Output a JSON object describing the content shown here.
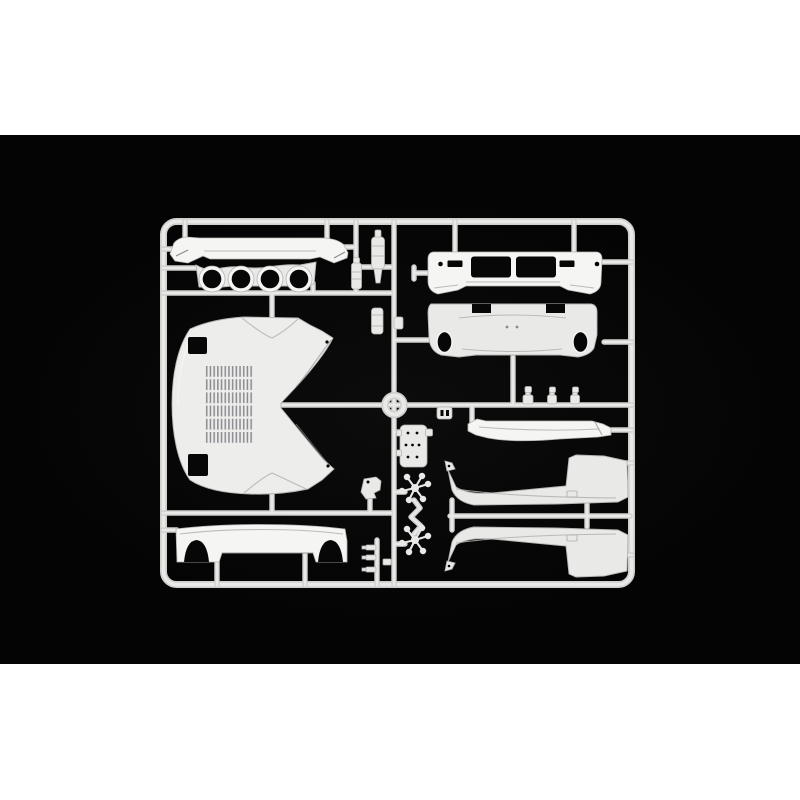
{
  "scene": {
    "type": "product-photo",
    "subject": "Injection-molded model kit sprue of white car body parts photographed on a black background",
    "text_visible": "none"
  },
  "colors": {
    "page_bg": "#ffffff",
    "photo_bg": "#040404",
    "plastic": "#e9e9e7",
    "plastic_bright": "#f5f5f3",
    "plastic_mid": "#cfcfcd",
    "plastic_shadow": "#b5b5b3",
    "plastic_dark": "#8a8a88",
    "vent_slat": "#8a8b91",
    "hole": "#070707"
  },
  "photo": {
    "alt": "White plastic model sprue with car body parts: hood with vent grille, spoilers, bumpers, quad headlamp panel and side skirts"
  },
  "parts": [
    {
      "id": "sprue-frame",
      "desc": "rounded rectangular runner frame with internal rails"
    },
    {
      "id": "runner-ring",
      "desc": "circular runner ring at frame center"
    },
    {
      "id": "rear-wing",
      "desc": "long rear wing blade, top left"
    },
    {
      "id": "quad-lamp-panel",
      "desc": "curved panel with four round lamp holes"
    },
    {
      "id": "front-hood",
      "desc": "large hood panel with louvered vent grille, two square lamp openings and deep concave notch"
    },
    {
      "id": "hood-vent-grille",
      "desc": "grid of dark vent slats on hood"
    },
    {
      "id": "rear-valance",
      "desc": "lower valance panel with two arched cutouts, bottom left"
    },
    {
      "id": "front-bumper",
      "desc": "bumper with two rectangular grille openings and end caps"
    },
    {
      "id": "rear-panel",
      "desc": "rear bumper panel with two oval exhaust holes and top notches"
    },
    {
      "id": "front-spoiler",
      "desc": "thin front air-dam blade with angled end plates"
    },
    {
      "id": "side-skirt-upper",
      "desc": "side sill panel, thin blade widening to tall end"
    },
    {
      "id": "side-skirt-lower",
      "desc": "mirrored side sill panel below runner"
    },
    {
      "id": "canister-upper",
      "desc": "small cylindrical canister part with tapered base"
    },
    {
      "id": "canister-lower",
      "desc": "small banded cylindrical canister part"
    },
    {
      "id": "bolt-part",
      "desc": "small cylindrical bolt on side rail"
    },
    {
      "id": "plate-bracket",
      "desc": "rounded plate with rows of small holes"
    },
    {
      "id": "caliper-bracket",
      "desc": "small irregular bracket part"
    },
    {
      "id": "spider-sprue-1",
      "desc": "six-armed star runner with tiny parts"
    },
    {
      "id": "spider-sprue-2",
      "desc": "six-armed star runner with tiny parts"
    },
    {
      "id": "mirror-fittings",
      "desc": "three tiny two-piece fittings on stems"
    },
    {
      "id": "clip-part",
      "desc": "small slotted clip under center rail"
    },
    {
      "id": "handle-parts",
      "desc": "stack of three tiny handle parts near bottom rail"
    }
  ]
}
